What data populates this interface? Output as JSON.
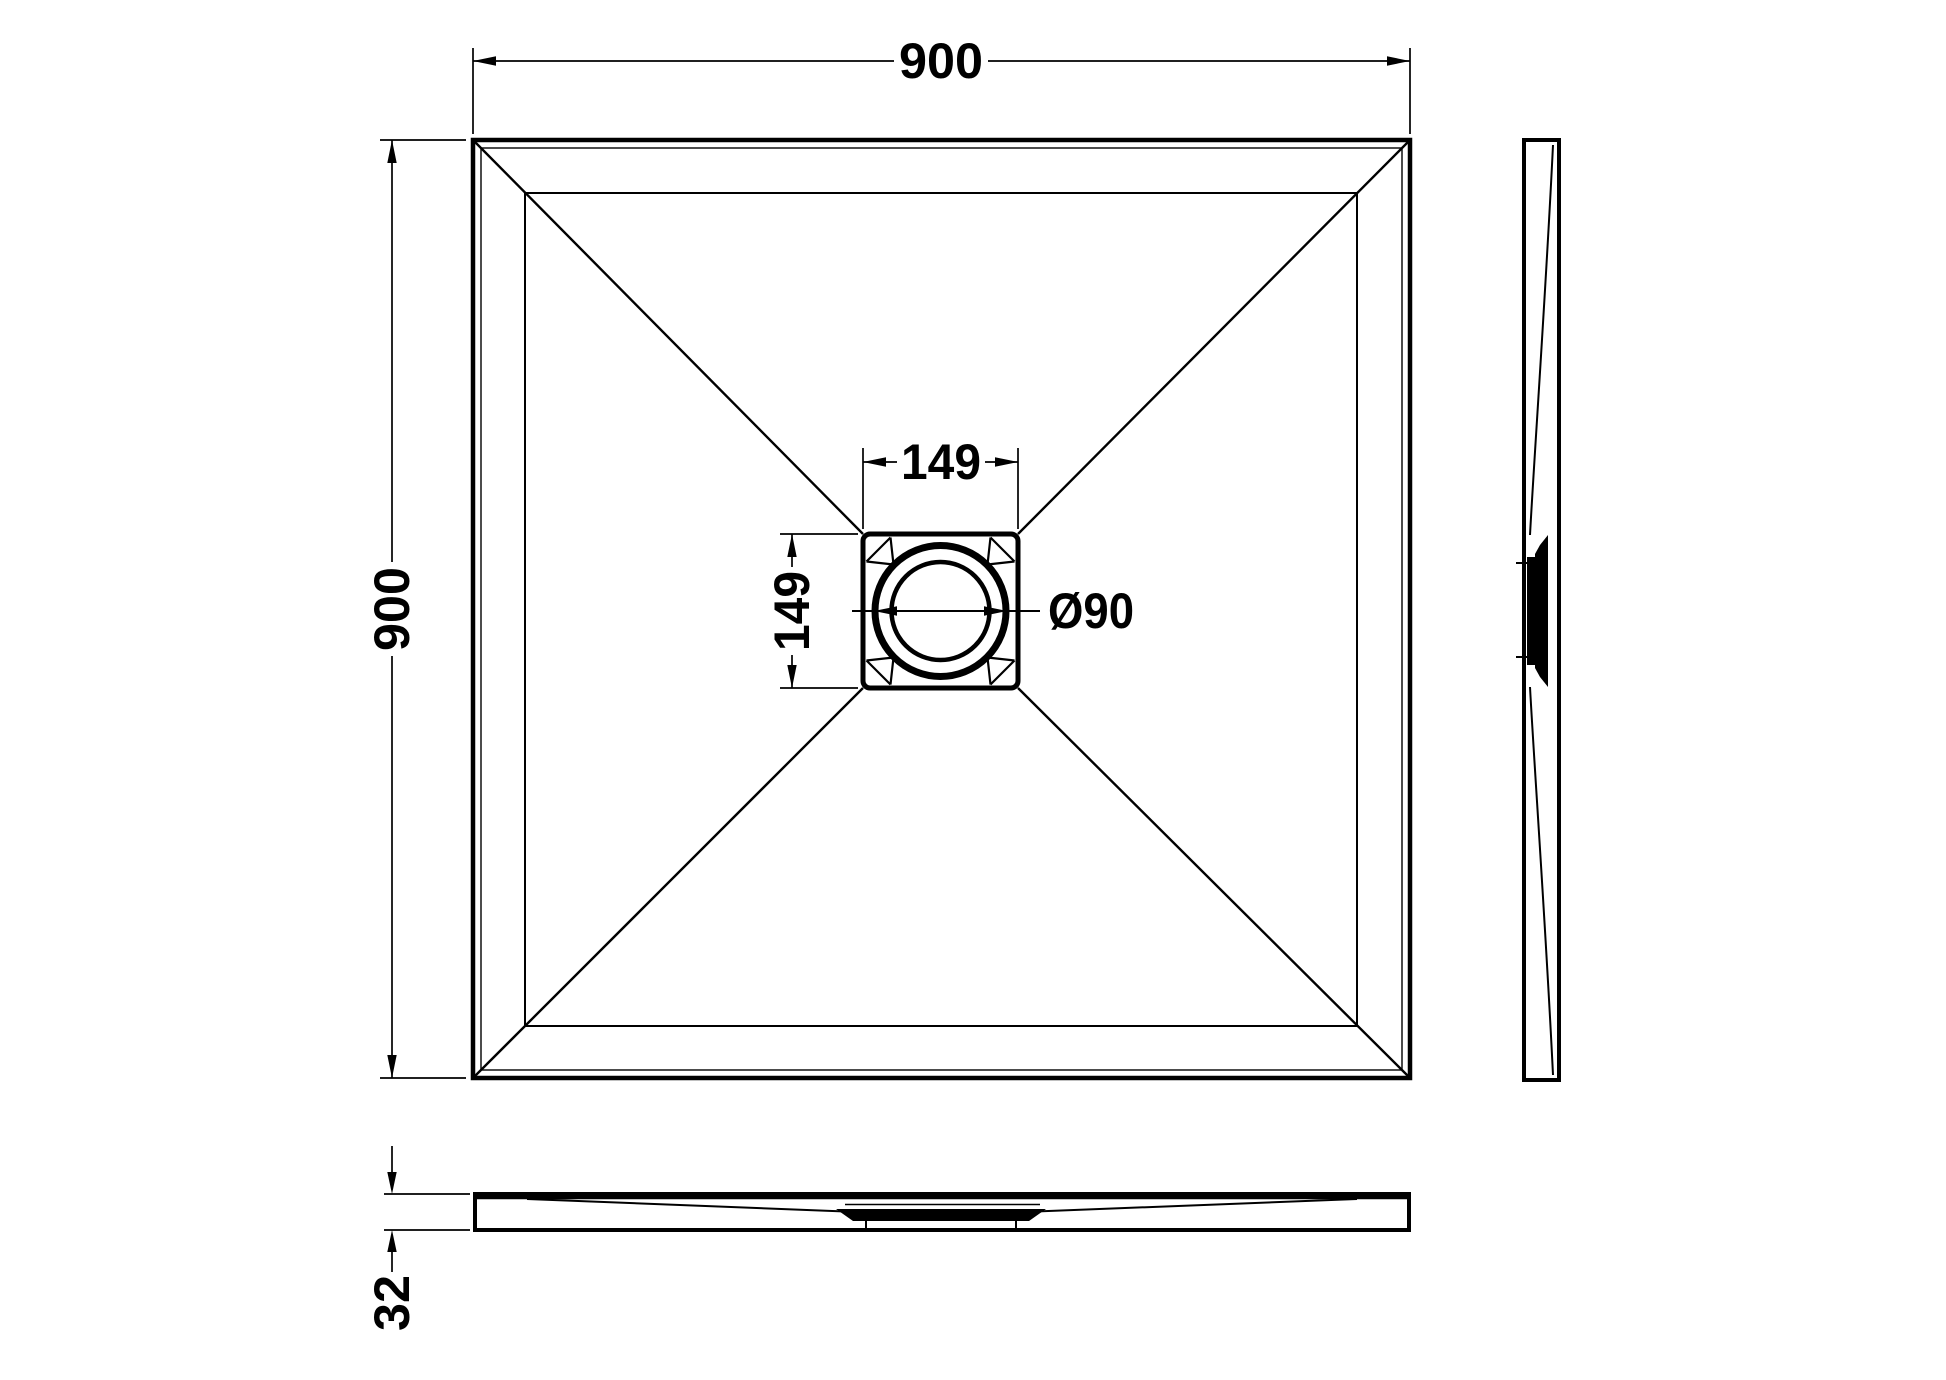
{
  "colors": {
    "line": "#000000",
    "background": "#ffffff"
  },
  "dims": {
    "overall_width": "900",
    "overall_depth": "900",
    "drain_box_width": "149",
    "drain_box_height": "149",
    "waste_diameter": "Ø90",
    "thickness": "32"
  }
}
